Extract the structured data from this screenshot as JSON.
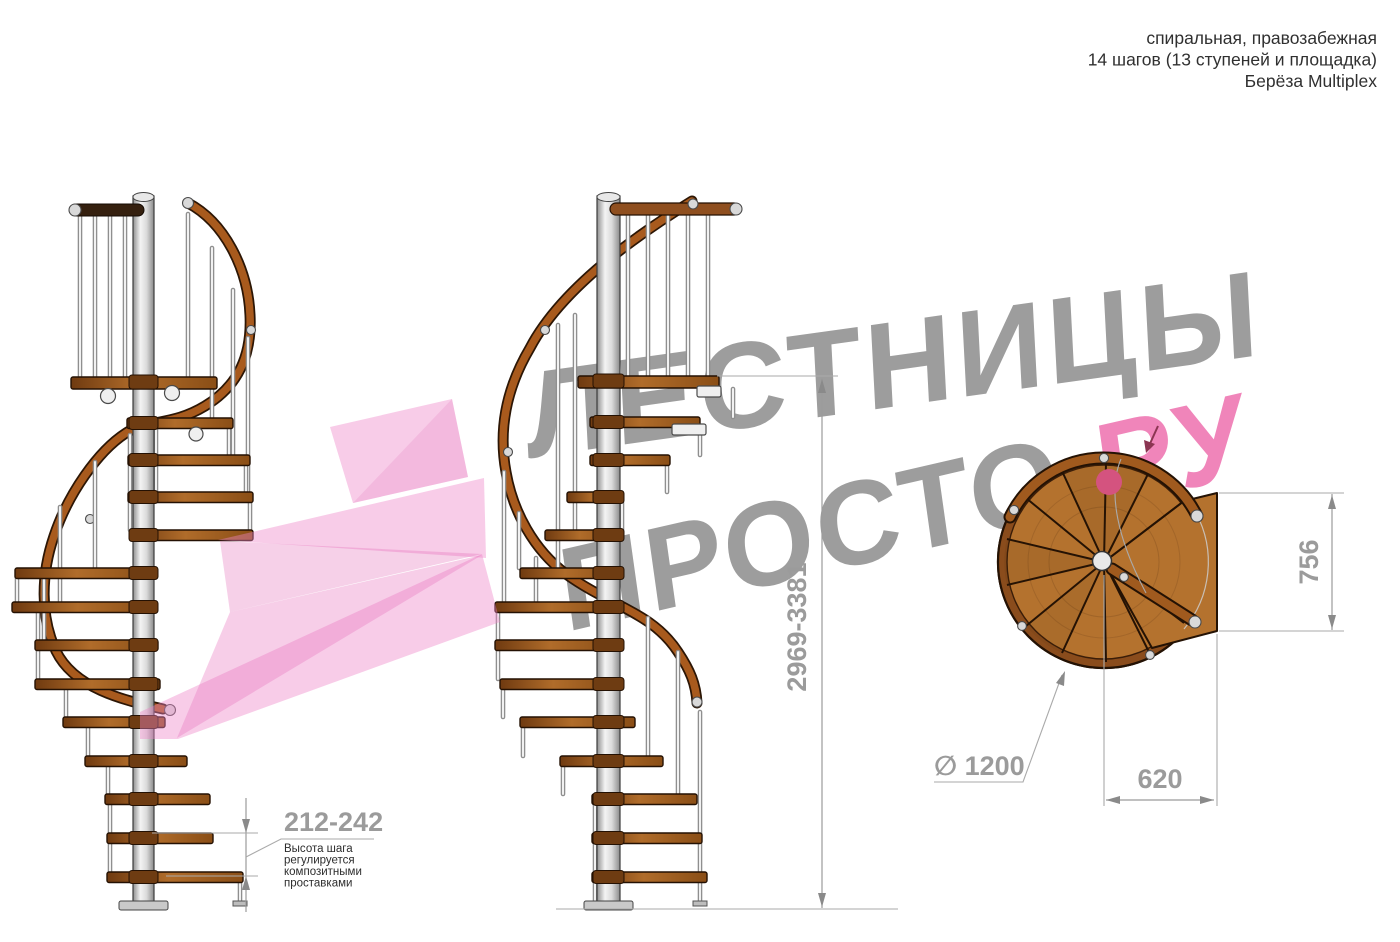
{
  "header": {
    "line1": "спиральная, правозабежная",
    "line2": "14 шагов (13 ступеней и площадка)",
    "line3": "Берёза Multiplex"
  },
  "watermark": {
    "line1": "ЛЕСТНИЦЫ",
    "line2_gray": "ПРОСТО",
    "line2_pink": ".РУ"
  },
  "dimensions": {
    "total_height": "2969-3381",
    "step_height": "212-242",
    "diameter": "∅ 1200",
    "platform_depth": "756",
    "platform_width": "620",
    "step_note": [
      "Высота шага",
      "регулируется",
      "композитными",
      "проставками"
    ]
  },
  "colors": {
    "accent_pink": "#f085ba",
    "watermark_gray": "#9d9d9d",
    "dimension_gray": "#9b9b9b",
    "wood": "#a96526",
    "ribbon_pink": "#ee85c7"
  }
}
